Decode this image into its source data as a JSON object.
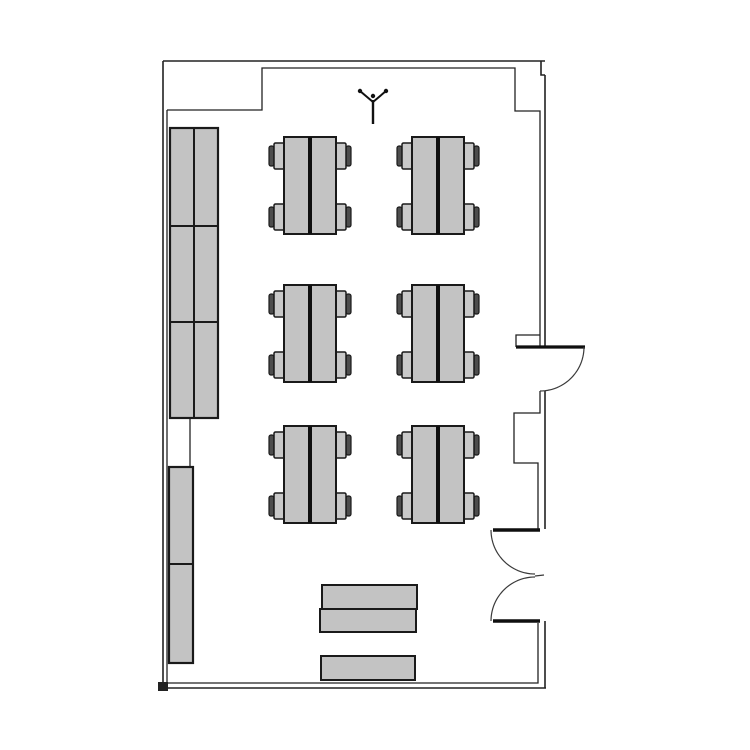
{
  "meta": {
    "title": "Room floor plan",
    "drawing_type": "floor-plan",
    "room": "classroom with six double tables, wall cabinets, one single door and one double door"
  },
  "canvas": {
    "width": 750,
    "height": 750,
    "background": "#ffffff"
  },
  "colors": {
    "wall": "#222222",
    "wall_thick": "#0f0f0f",
    "door_arc": "#3a3a3a",
    "furniture_fill": "#c3c3c3",
    "furniture_stroke": "#1a1a1a",
    "chair_seat_fill": "#c9c9c9",
    "chair_back_fill": "#4d4d4d",
    "divider": "#0f0f0f",
    "symbol": "#111111"
  },
  "walls": {
    "outer": [
      [
        [
          163,
          61
        ],
        [
          545,
          61
        ]
      ],
      [
        [
          163,
          61
        ],
        [
          163,
          688
        ]
      ],
      [
        [
          163,
          688
        ],
        [
          546,
          688
        ]
      ],
      [
        [
          541,
          61
        ],
        [
          541,
          75
        ],
        [
          545,
          75
        ]
      ],
      [
        [
          545,
          75
        ],
        [
          545,
          347
        ]
      ],
      [
        [
          545,
          391
        ],
        [
          545,
          529
        ]
      ],
      [
        [
          545,
          621
        ],
        [
          545,
          688
        ]
      ]
    ],
    "inner": [
      [
        [
          167,
          110
        ],
        [
          262,
          110
        ],
        [
          262,
          68
        ],
        [
          515,
          68
        ],
        [
          515,
          111
        ],
        [
          540,
          111
        ],
        [
          540,
          347
        ]
      ],
      [
        [
          540,
          335
        ],
        [
          516,
          335
        ],
        [
          516,
          347
        ]
      ],
      [
        [
          540,
          391
        ],
        [
          540,
          413
        ],
        [
          514,
          413
        ],
        [
          514,
          463
        ],
        [
          538,
          463
        ],
        [
          538,
          529
        ]
      ],
      [
        [
          538,
          623
        ],
        [
          538,
          683
        ],
        [
          167,
          683
        ]
      ],
      [
        [
          167,
          683
        ],
        [
          167,
          110
        ]
      ],
      [
        [
          190,
          418
        ],
        [
          190,
          467
        ]
      ]
    ],
    "corner_foot": {
      "x": 158,
      "y": 682,
      "w": 10,
      "h": 9
    }
  },
  "doors": {
    "single_door": {
      "leaf": [
        [
          516,
          347
        ],
        [
          585,
          347
        ]
      ],
      "arc": {
        "cx": 540,
        "cy": 347,
        "r": 44,
        "start": 0,
        "end": 90
      }
    },
    "double_door": {
      "leaves": [
        [
          [
            493,
            530
          ],
          [
            540,
            530
          ]
        ],
        [
          [
            493,
            621
          ],
          [
            540,
            621
          ]
        ]
      ],
      "arcs": [
        {
          "cx": 535,
          "cy": 530,
          "r": 44,
          "start": 180,
          "end": 90
        },
        {
          "cx": 535,
          "cy": 621,
          "r": 44,
          "start": 180,
          "end": 270
        }
      ],
      "tick": [
        [
          535,
          576
        ],
        [
          544,
          575
        ]
      ]
    }
  },
  "furniture": {
    "cabinets": [
      {
        "x": 170,
        "y": 128,
        "w": 48,
        "h": 290,
        "col_dividers": [
          24
        ],
        "row_dividers": [
          98,
          194
        ]
      },
      {
        "x": 169,
        "y": 467,
        "w": 24,
        "h": 196,
        "col_dividers": [],
        "row_dividers": [
          97
        ]
      }
    ],
    "table_groups": {
      "table": {
        "w": 52,
        "h": 97,
        "divider_w": 4
      },
      "chair": {
        "seat_w": 11,
        "seat_h": 26,
        "back_w": 5,
        "back_h": 20,
        "top_offset": 6,
        "bottom_offset": 30
      },
      "positions": [
        {
          "x": 284,
          "y": 137
        },
        {
          "x": 412,
          "y": 137
        },
        {
          "x": 284,
          "y": 285
        },
        {
          "x": 412,
          "y": 285
        },
        {
          "x": 284,
          "y": 426
        },
        {
          "x": 412,
          "y": 426
        }
      ]
    },
    "side_tables": [
      {
        "x": 322,
        "y": 585,
        "w": 95,
        "h": 24
      },
      {
        "x": 320,
        "y": 609,
        "w": 96,
        "h": 23
      },
      {
        "x": 321,
        "y": 656,
        "w": 94,
        "h": 24
      }
    ]
  },
  "ceiling_symbol": {
    "stem": [
      [
        373,
        100
      ],
      [
        373,
        124
      ]
    ],
    "arms": [
      [
        [
          373,
          102
        ],
        [
          360,
          91
        ]
      ],
      [
        [
          373,
          102
        ],
        [
          386,
          91
        ]
      ]
    ],
    "dots": [
      {
        "x": 360,
        "y": 91
      },
      {
        "x": 386,
        "y": 91
      },
      {
        "x": 373,
        "y": 96
      }
    ],
    "dot_r": 2.2
  }
}
